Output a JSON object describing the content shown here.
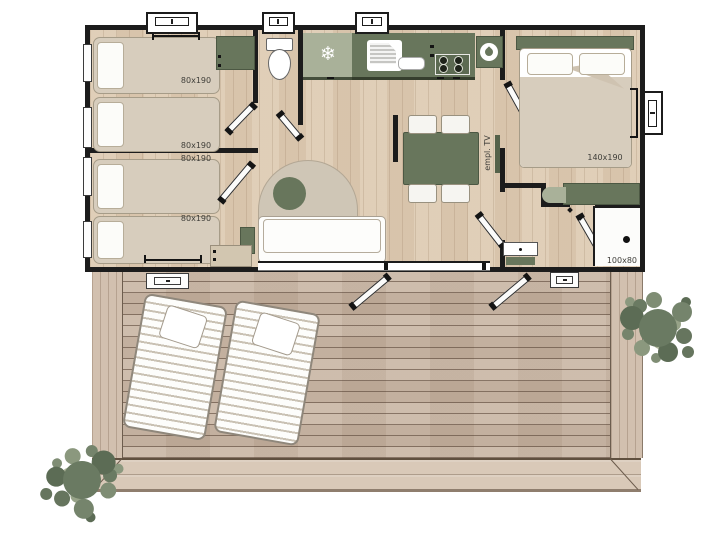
{
  "floorplan": {
    "bedroom_1": {
      "bed_a_label": "80x190",
      "bed_b_label": "80x190"
    },
    "bedroom_2": {
      "bed_a_label": "80x190",
      "bed_b_label": "80x190"
    },
    "master_bedroom": {
      "bed_label": "140x190"
    },
    "bathroom": {
      "shower_label": "100x80"
    },
    "living_room": {
      "tv_label": "empl. TV"
    },
    "kitchen": {
      "fridge_glyph": "❄"
    },
    "icons": {
      "fridge": "snowflake-icon",
      "water_heater": "water-drop-icon"
    },
    "colors": {
      "wall": "#1c1c1c",
      "interior_floor": "#decbb3",
      "deck_wood": "#c8b5a3",
      "accent_dark_sage": "#68765c",
      "accent_light_sage": "#a9b199",
      "bed_fabric": "#d7cdbd",
      "tree_foliage": "#6a7a62"
    }
  }
}
